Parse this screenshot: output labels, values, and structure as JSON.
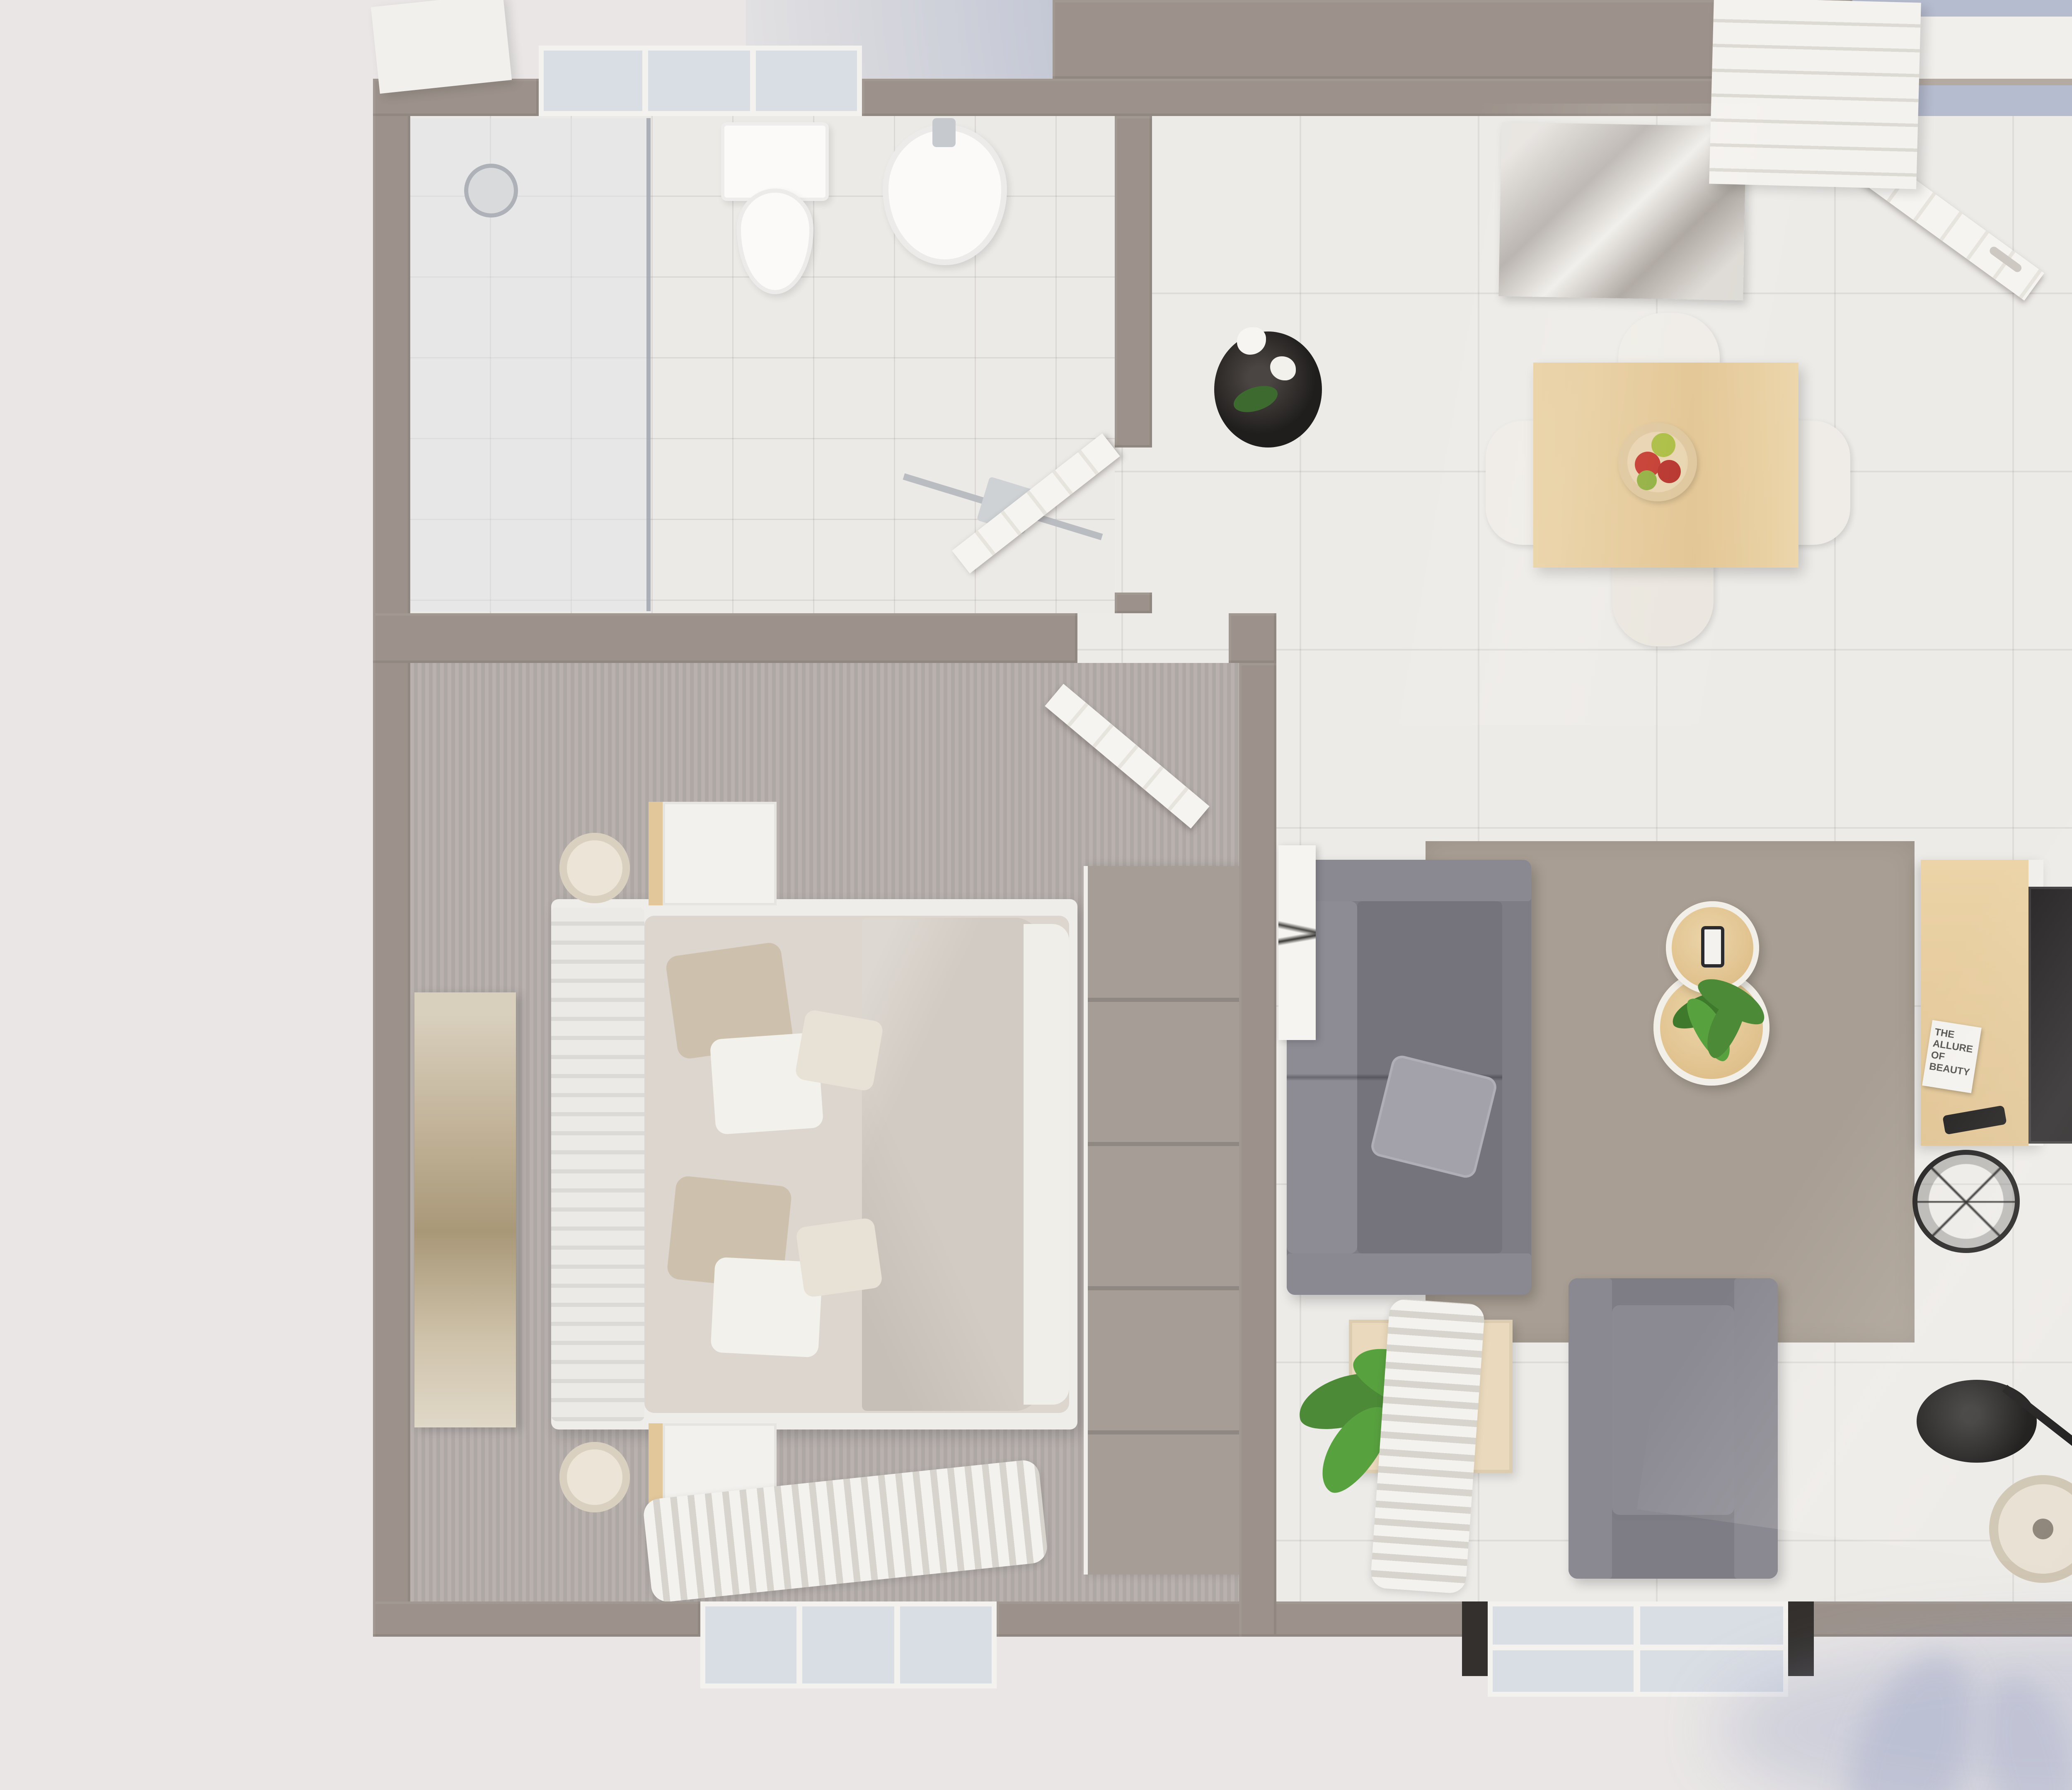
{
  "scene": {
    "title": "Top-down 3D render of a two-bedroom apartment floor plan",
    "magazine_title": "THE ALLURE OF BEAUTY",
    "palette": {
      "wall": "#9c928b",
      "background": "#e9e6e5",
      "sky_shadow": "#b5bccf",
      "floor_tile": "#edebe8",
      "bathroom_tile": "#eceae7",
      "carpet": "#b4adaa",
      "area_rug": "#a89e93",
      "wood_light": "#e3c99c",
      "kitchen_counter": "#39342f",
      "sofa_gray": "#7e7c85",
      "bedding": "#d8d2cb",
      "dark_headboard": "#6e6b6e",
      "plant_green": "#4c8a37",
      "lamp_shade": "#e8e0d2",
      "tv_black": "#262425"
    },
    "rooms": [
      {
        "name": "bathroom",
        "position": "top-left",
        "items": [
          "shower enclosure",
          "glass partition",
          "shower head",
          "toilet",
          "wall-hung washbasin",
          "towel rail with towels",
          "frosted window",
          "door open inward"
        ]
      },
      {
        "name": "hallway-entry",
        "position": "top-center",
        "items": [
          "entry door open",
          "porch roof",
          "mountain artwork on wall",
          "orchid in black planter",
          "light switch"
        ]
      },
      {
        "name": "dining-area",
        "position": "center-top",
        "items": [
          "square wood dining table",
          "fruit bowl with apples and pears",
          "dining chair top",
          "dining chair bottom",
          "dining chair left",
          "dining chair right"
        ]
      },
      {
        "name": "kitchen",
        "position": "top-right",
        "items": [
          "tall gray cabinet",
          "dark speckled L-counter",
          "double stainless sink",
          "drainer board",
          "faucet",
          "potted plant",
          "three spice jars",
          "wood cutting board",
          "4-burner gas hob",
          "oven",
          "wood base cabinets"
        ]
      },
      {
        "name": "bedroom-left",
        "position": "left",
        "items": [
          "double bed",
          "white slatted headboard",
          "beige and white pillows",
          "cream duvet",
          "nightstand top",
          "nightstand bottom",
          "wall lamp top",
          "wall lamp bottom",
          "gold abstract artwork",
          "tall gray wardrobe",
          "window with curtains",
          "door open inward"
        ]
      },
      {
        "name": "living-room",
        "position": "center",
        "items": [
          "gray fabric sofa",
          "gray scatter cushion",
          "round nesting coffee tables",
          "smartphone",
          "small potted plant",
          "wood side table",
          "large potted plant",
          "gray armchair",
          "taupe area rug",
          "tv sideboard",
          "magazine",
          "tv remote",
          "wall-mounted tv",
          "black wire basket",
          "black floor lamp with cream shade",
          "tree-branch artwork",
          "sliding window with curtain"
        ]
      },
      {
        "name": "bedroom-right",
        "position": "right",
        "items": [
          "double bed",
          "dark gray headboard",
          "white pillows",
          "gray duvet",
          "white throw blanket",
          "nightstand top",
          "nightstand bottom",
          "wall lamp top",
          "wall lamp bottom",
          "marble abstract artwork",
          "sliding-door wardrobe",
          "white dresser",
          "window with curtains",
          "door open inward"
        ]
      }
    ]
  }
}
